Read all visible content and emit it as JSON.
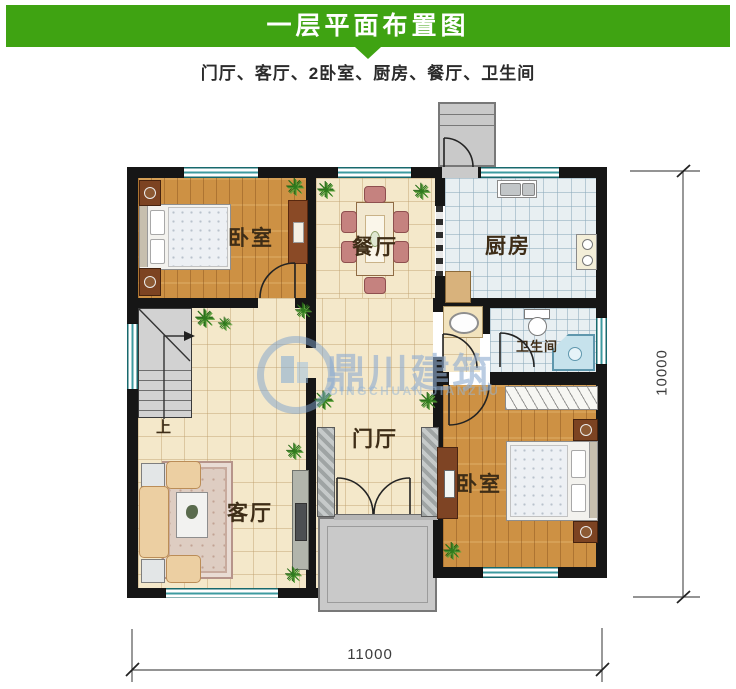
{
  "header": {
    "title": "一层平面布置图",
    "subtitle": "门厅、客厅、2卧室、厨房、餐厅、卫生间"
  },
  "labels": {
    "bedroom_tl": "卧室",
    "dining": "餐厅",
    "kitchen": "厨房",
    "bathroom": "卫生间",
    "hall": "门厅",
    "living": "客厅",
    "bedroom_br": "卧室",
    "stairs_up": "上"
  },
  "dimensions": {
    "bottom_width": "11000",
    "right_height": "10000"
  },
  "watermark": {
    "brand": "鼎川建筑",
    "brand_latin": "DINGCHUAN JIANZHU"
  },
  "colors": {
    "header_green": "#3fa312",
    "wall_black": "#161616",
    "wood_floor": "#cd9144",
    "tile_cream": "#f4e8ca",
    "tile_blue": "#e8eff2",
    "window_teal": "#3d9ba0",
    "watermark_blue": "#8fadd0"
  }
}
